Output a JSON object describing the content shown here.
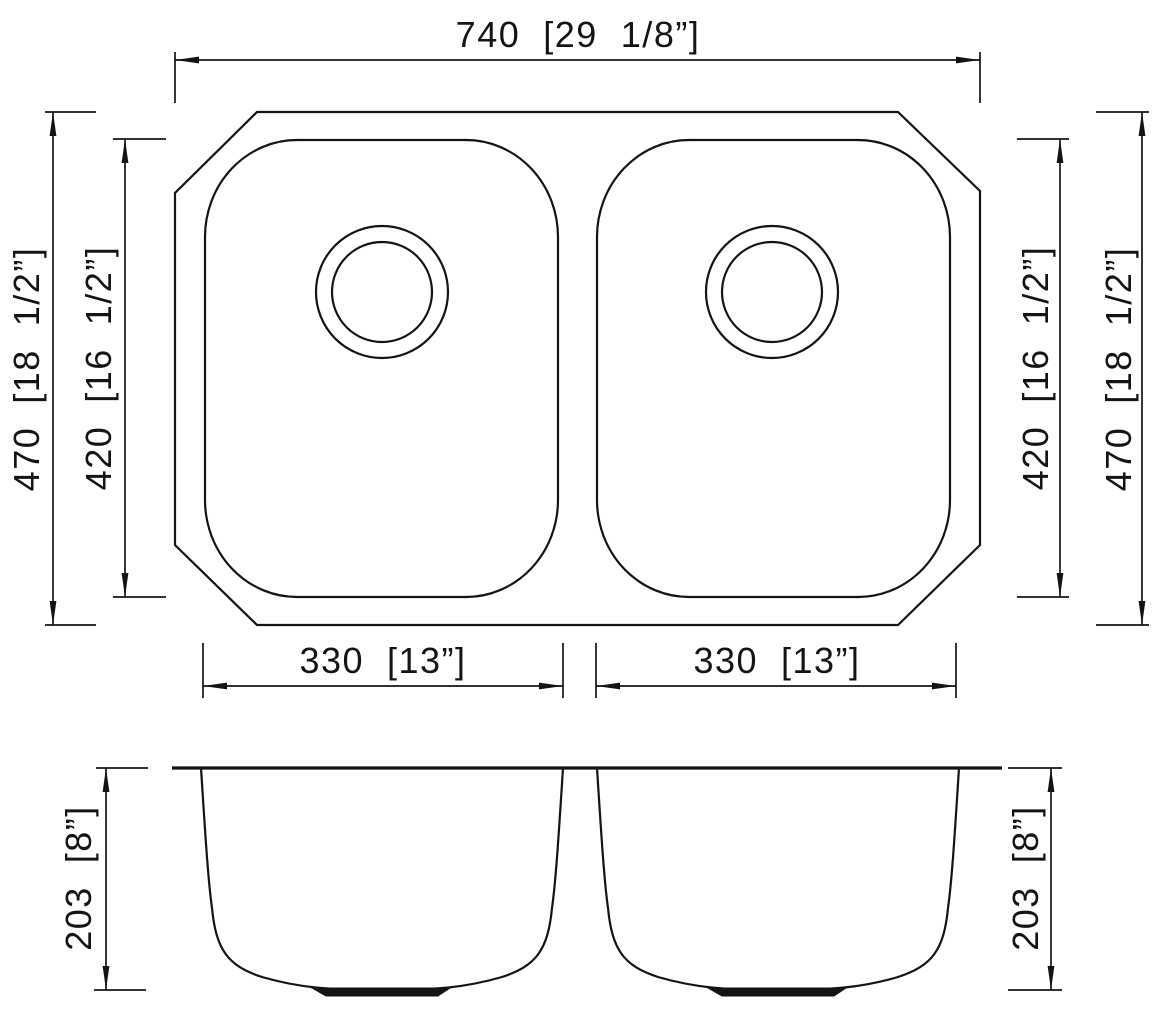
{
  "labels": {
    "overall_width": "740  [29  1/8”]",
    "outer_height_left": "470  [18  1/2”]",
    "inner_height_left": "420  [16  1/2”]",
    "inner_height_right": "420  [16  1/2”]",
    "outer_height_right": "470  [18  1/2”]",
    "left_bowl_width": "330  [13”]",
    "right_bowl_width": "330  [13”]",
    "bowl_depth_left": "203  [8”]",
    "bowl_depth_right": "203  [8”]"
  },
  "style": {
    "line_color": "#141414",
    "background": "#ffffff"
  }
}
